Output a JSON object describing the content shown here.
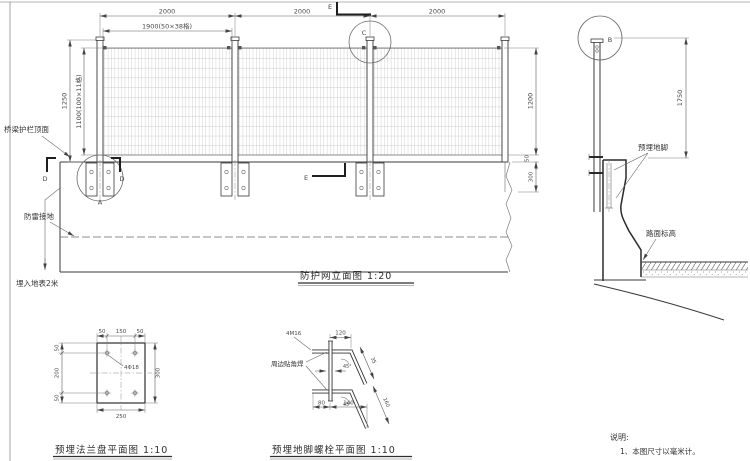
{
  "colors": {
    "background": "#ffffff",
    "ink": "#3a3a3a",
    "dim_line": "#5a5a5a"
  },
  "elevation": {
    "title": "防护网立面图  1:20",
    "dim_span1": "2000",
    "dim_span2": "2000",
    "dim_span3": "2000",
    "dim_mesh_width": "1900(50×38格)",
    "dim_height_outer": "1250",
    "dim_mesh_height": "1100(100×11格)",
    "dim_right_mesh": "1200",
    "dim_right_gap": "50",
    "dim_right_barrier": "300",
    "label_rail_top": "桥梁护栏顶面",
    "label_grounding": "防雷接地",
    "label_buried": "埋入地表2米",
    "callout_a": "A",
    "callout_c": "C",
    "cut_d": "D",
    "cut_e": "E"
  },
  "section": {
    "callout_b": "B",
    "dim_height": "1750",
    "label_anchor": "预埋地脚",
    "label_road": "路面标高"
  },
  "flange_detail": {
    "title": "预埋法兰盘平面图  1:10",
    "dim_top_left": "50",
    "dim_top_mid": "150",
    "dim_top_right": "50",
    "dim_left_top": "50",
    "dim_left_mid": "200",
    "dim_left_bot": "50",
    "dim_right": "300",
    "dim_bottom": "250",
    "leader_holes": "4Φ18"
  },
  "bolt_detail": {
    "title": "预埋地脚螺栓平面图  1:10",
    "label_bolts": "4M16",
    "label_weld": "周边贴角焊",
    "dim_top": "120",
    "dim_bot_left": "80",
    "dim_bot_right": "140",
    "dim_slant_top": "35",
    "dim_slant_bot": "160",
    "angle_top": "45°",
    "angle_bot": "45°"
  },
  "notes": {
    "heading": "说明:",
    "item1": "1、本图尺寸以毫米计。"
  }
}
